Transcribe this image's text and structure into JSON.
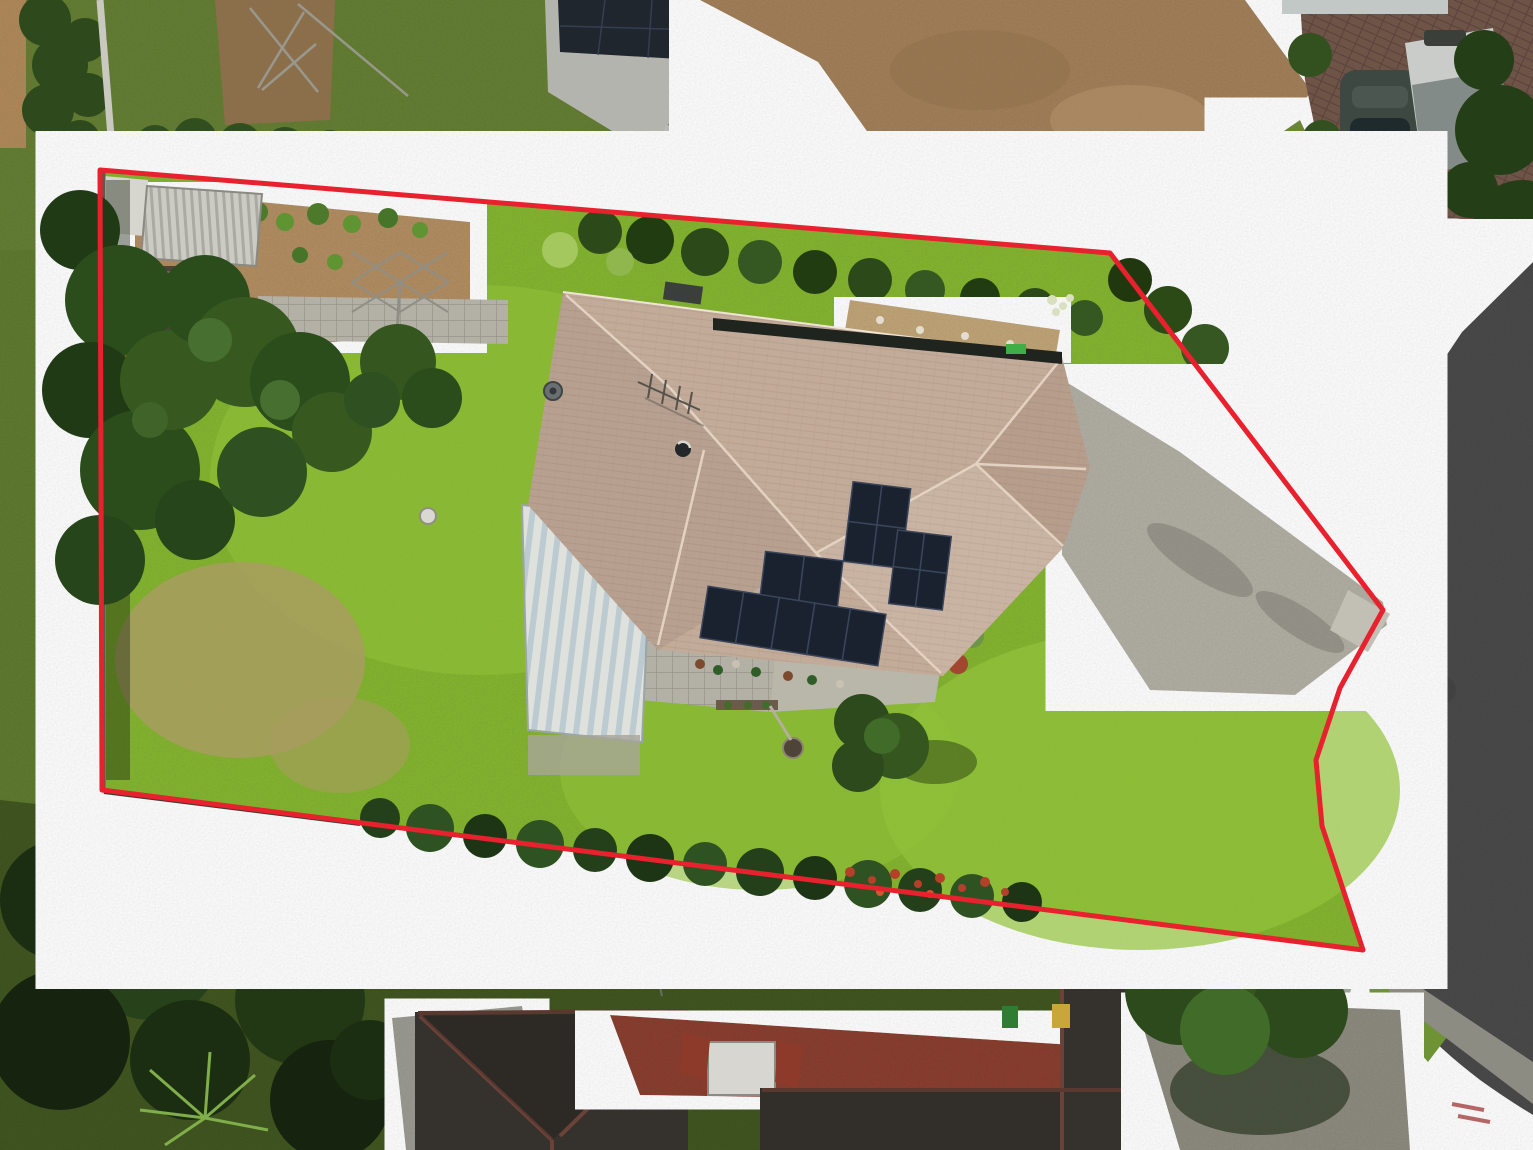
{
  "image": {
    "kind": "aerial-drone-photo",
    "subject": "suburban house lot outlined with red property-boundary overlay, cul-de-sac road at right",
    "width_px": 1533,
    "height_px": 1150
  },
  "palette": {
    "boundary_red": "#e8212e",
    "lawn_bright": "#85b531",
    "lawn_sunlit": "#9aca40",
    "lawn_dry_patch": "#a89c60",
    "surround_lawn": "#5f7a30",
    "tree_dark": "#223915",
    "tree_mid": "#31511e",
    "hedge": "#2c4a19",
    "roof_tile_tan": "#c3ab99",
    "roof_ridge": "#e2d1c0",
    "garage_white": "#d7dad4",
    "shed_metal": "#c9c9c1",
    "solar_panel": "#1a2230",
    "driveway_concrete": "#b2afa4",
    "road_asphalt": "#4a4a4a",
    "road_gutter": "#9b9b91",
    "footpath": "#8c8c82",
    "brick_paving": "#6e5347",
    "dirt_driveway": "#a2805a",
    "mulch": "#b28e62",
    "courtyard_red": "#8a3f2f",
    "neighbor_roof_dark": "#35312c",
    "neighbor_roof_grey": "#b4b4ae",
    "caravan_body": "#c9ccc8",
    "car_dark": "#3d4843",
    "car_silver": "#9fa8a4",
    "bin_green": "#2e7d32",
    "bin_yellow": "#c8a63a",
    "flower_red": "#b5402a"
  },
  "boundary": {
    "stroke_width": 5,
    "points": "100,170 1110,253 1383,610 1340,688 1316,760 1322,826 1334,862 1363,950 102,790 100,170"
  },
  "property": {
    "house": {
      "roof": "hipped tan concrete-tile roof",
      "solar_panels_total": 15,
      "solar_arrays": [
        {
          "name": "upper-array",
          "panels": 4
        },
        {
          "name": "right-array",
          "panels": 4
        },
        {
          "name": "middle-pair",
          "panels": 2
        },
        {
          "name": "lower-row",
          "panels": 5
        }
      ],
      "rooftop_items": [
        "tv-antenna",
        "satellite-dish",
        "roof-vent",
        "rooftop-unit",
        "green-wheelie-bin-behind-roof"
      ]
    },
    "garage": "white ribbed-roof garage attached at left of house",
    "backyard_items": [
      "garden-shed",
      "small-shed",
      "pergola-with-pots",
      "vegetable-garden",
      "rotary-clothesline",
      "paved-path",
      "bird-bath",
      "conifer-trees",
      "dry-lawn-patch"
    ],
    "frontyard_items": [
      "lawn",
      "paved-patio-with-pots",
      "garden-bed",
      "feature-tree",
      "fire-pit",
      "concrete-driveway"
    ],
    "boundary_planting": [
      "north-hedge",
      "north-east-hedge",
      "south-hedge-with-red-flowers",
      "west-fence-line"
    ]
  },
  "surroundings": {
    "north": [
      "neighbor-grey-roof-with-solar",
      "access-ramp",
      "tan-dirt-driveway",
      "trimmed-hedges",
      "fallen-antenna-on-dirt"
    ],
    "north_east": [
      "brick-parking-area",
      "dark-parked-car",
      "caravan",
      "silver-parked-car",
      "shrub-row",
      "neighbor-concrete-driveway",
      "grass-verge"
    ],
    "east": [
      "cul-de-sac-road",
      "kerb-and-gutter",
      "footpath",
      "faint-red-paint-marks-on-road"
    ],
    "south": [
      "shadowed-trees",
      "palm-plant",
      "garden-path",
      "dark-roof-house-left",
      "red-paved-courtyard",
      "white-box-truck",
      "dark-roof-house-right",
      "green-wheelie-bin",
      "yellow-wheelie-bin",
      "neighbor-driveway-with-tree",
      "small-white-trailer-on-grass"
    ]
  },
  "vehicle_counts": {
    "cars": 2,
    "caravans": 1,
    "trucks": 1
  }
}
